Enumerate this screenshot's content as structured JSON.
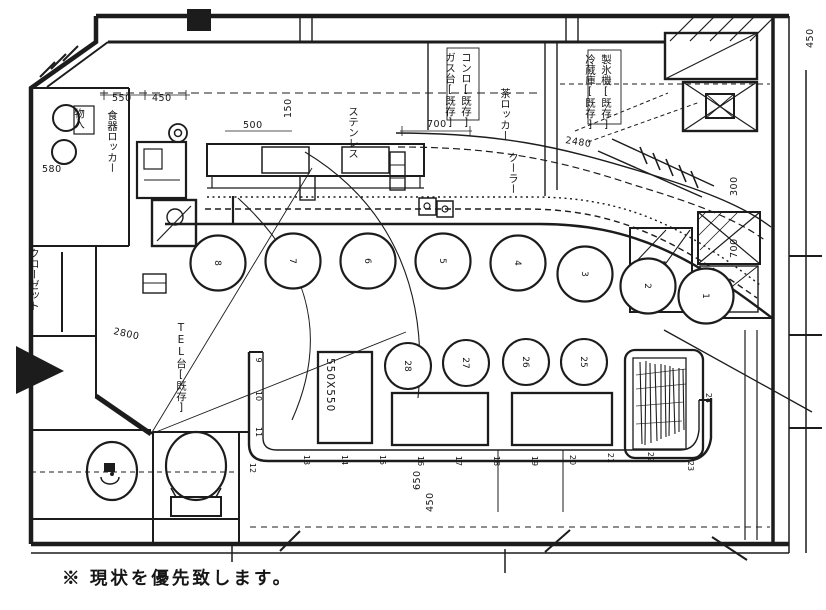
{
  "caption": "※ 現状を優先致します。",
  "plan": {
    "dimension_labels": [
      {
        "t": "550",
        "x": 112,
        "y": 101,
        "r": 0
      },
      {
        "t": "450",
        "x": 152,
        "y": 101,
        "r": 0
      },
      {
        "t": "500",
        "x": 243,
        "y": 128,
        "r": 0
      },
      {
        "t": "150",
        "x": 291,
        "y": 118,
        "r": -90
      },
      {
        "t": "700",
        "x": 427,
        "y": 127,
        "r": 0
      },
      {
        "t": "2480",
        "x": 565,
        "y": 143,
        "r": 9
      },
      {
        "t": "580",
        "x": 42,
        "y": 172,
        "r": 0
      },
      {
        "t": "2800",
        "x": 113,
        "y": 334,
        "r": 12
      },
      {
        "t": "650",
        "x": 420,
        "y": 490,
        "r": -90
      },
      {
        "t": "450",
        "x": 433,
        "y": 512,
        "r": -90
      },
      {
        "t": "300",
        "x": 737,
        "y": 196,
        "r": -90
      },
      {
        "t": "700",
        "x": 737,
        "y": 258,
        "r": -90
      },
      {
        "t": "450",
        "x": 813,
        "y": 48,
        "r": -90
      }
    ],
    "text_labels": [
      {
        "t": "物入",
        "x": 79,
        "y": 108,
        "v": 1
      },
      {
        "t": "食器ロッカー",
        "x": 112,
        "y": 110,
        "v": 1
      },
      {
        "t": "クローゼット",
        "x": 34,
        "y": 248,
        "v": 1
      },
      {
        "t": "TEL台[既存]",
        "x": 181,
        "y": 322,
        "v": 1
      },
      {
        "t": "ステンレス",
        "x": 353,
        "y": 106,
        "v": 1
      },
      {
        "t": "ガス台[既存]",
        "x": 450,
        "y": 52,
        "v": 1
      },
      {
        "t": "コンロ[既存]",
        "x": 466,
        "y": 52,
        "v": 1
      },
      {
        "t": "茶ロッカー",
        "x": 505,
        "y": 88,
        "v": 1
      },
      {
        "t": "クーラー",
        "x": 513,
        "y": 152,
        "v": 1
      },
      {
        "t": "冷蔵庫[既存]",
        "x": 590,
        "y": 54,
        "v": 1
      },
      {
        "t": "製氷機[既存]",
        "x": 606,
        "y": 54,
        "v": 1
      },
      {
        "t": "550X550",
        "x": 327,
        "y": 358,
        "r": 90
      }
    ],
    "counter_stools": [
      {
        "n": "8",
        "cx": 218,
        "cy": 263
      },
      {
        "n": "7",
        "cx": 293,
        "cy": 261
      },
      {
        "n": "6",
        "cx": 368,
        "cy": 261
      },
      {
        "n": "5",
        "cx": 443,
        "cy": 261
      },
      {
        "n": "4",
        "cx": 518,
        "cy": 263
      },
      {
        "n": "3",
        "cx": 585,
        "cy": 274
      },
      {
        "n": "2",
        "cx": 648,
        "cy": 286
      },
      {
        "n": "1",
        "cx": 706,
        "cy": 296
      }
    ],
    "floor_stools": [
      {
        "n": "28",
        "cx": 408,
        "cy": 366
      },
      {
        "n": "27",
        "cx": 466,
        "cy": 363
      },
      {
        "n": "26",
        "cx": 526,
        "cy": 362
      },
      {
        "n": "25",
        "cx": 584,
        "cy": 362
      }
    ],
    "bench_seats": [
      {
        "n": "9",
        "x": 256,
        "y": 360
      },
      {
        "n": "10",
        "x": 256,
        "y": 396
      },
      {
        "n": "11",
        "x": 256,
        "y": 432
      },
      {
        "n": "12",
        "x": 250,
        "y": 468
      },
      {
        "n": "13",
        "x": 304,
        "y": 460
      },
      {
        "n": "14",
        "x": 342,
        "y": 460
      },
      {
        "n": "15",
        "x": 380,
        "y": 460
      },
      {
        "n": "16",
        "x": 418,
        "y": 461
      },
      {
        "n": "17",
        "x": 456,
        "y": 461
      },
      {
        "n": "18",
        "x": 494,
        "y": 461
      },
      {
        "n": "19",
        "x": 532,
        "y": 461
      },
      {
        "n": "20",
        "x": 570,
        "y": 460
      },
      {
        "n": "21",
        "x": 608,
        "y": 458
      },
      {
        "n": "22",
        "x": 648,
        "y": 457
      },
      {
        "n": "23",
        "x": 688,
        "y": 466
      },
      {
        "n": "24",
        "x": 706,
        "y": 398
      }
    ]
  }
}
